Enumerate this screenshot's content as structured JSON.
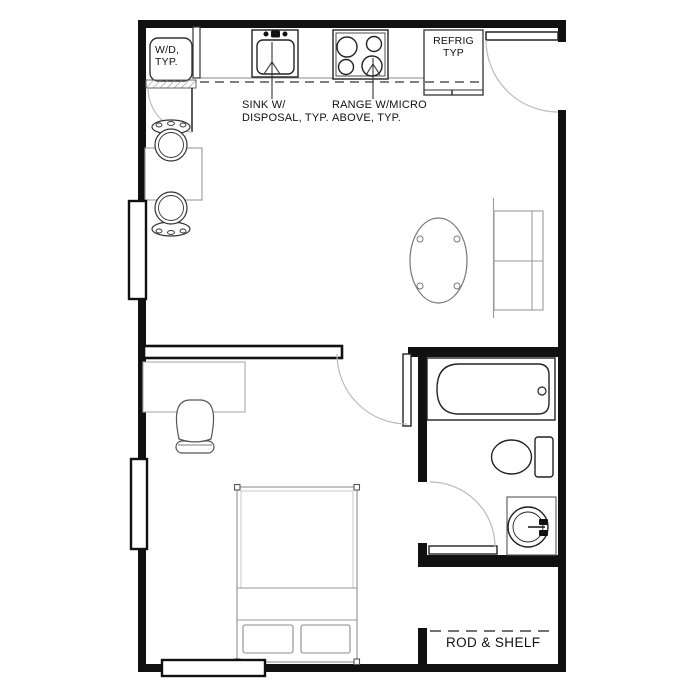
{
  "floor_plan": {
    "labels": {
      "washer_dryer": {
        "line1": "W/D,",
        "line2": "TYP."
      },
      "sink": {
        "line1": "SINK W/",
        "line2": "DISPOSAL, TYP."
      },
      "range": {
        "line1": "RANGE W/MICRO",
        "line2": "ABOVE, TYP."
      },
      "refrigerator": {
        "line1": "REFRIG",
        "line2": "TYP"
      },
      "closet": {
        "label": "ROD & SHELF"
      }
    },
    "colors": {
      "background": "#ffffff",
      "wall": "#111111",
      "fixture_line": "#222222",
      "furniture_line": "#9a9a9a",
      "door_arc": "#bbbbbb",
      "dashed_line": "#555555",
      "label_text": "#111111"
    }
  }
}
